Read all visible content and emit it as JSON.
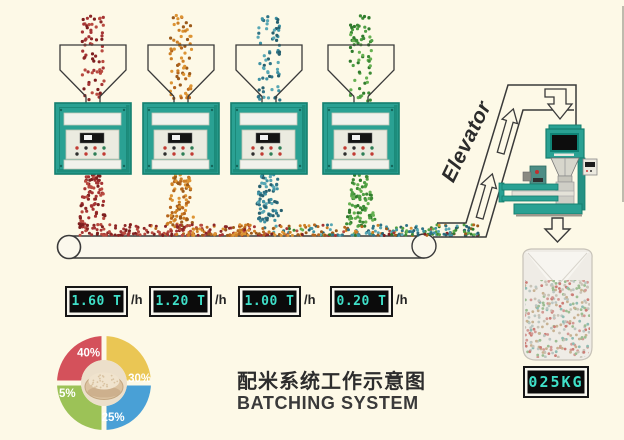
{
  "title": {
    "zh": "配米系统工作示意图",
    "en": "BATCHING SYSTEM"
  },
  "elevator_label": "Elevator",
  "machines": [
    {
      "id": "batcher-1",
      "throughput": "1.60 T",
      "unit": "/h",
      "grain": "red",
      "share": "40%"
    },
    {
      "id": "batcher-2",
      "throughput": "1.20 T",
      "unit": "/h",
      "grain": "orange",
      "share": "30%"
    },
    {
      "id": "batcher-3",
      "throughput": "1.00 T",
      "unit": "/h",
      "grain": "blue",
      "share": "25%"
    },
    {
      "id": "batcher-4",
      "throughput": "0.20 T",
      "unit": "/h",
      "grain": "green",
      "share": "5%"
    }
  ],
  "bag": {
    "weight_display": "025KG"
  },
  "colors": {
    "background": "#fdf9e7",
    "machine_teal": "#2aa193",
    "machine_teal_dark": "#157f6f",
    "lcd_text": "#3fe0c9",
    "outline": "#3a3a3a",
    "panel_light": "#ebebe0",
    "strip_white": "#f1f2ec"
  },
  "grain_palettes": {
    "red": [
      "#a63434",
      "#8c2626",
      "#b94b40",
      "#7d1f1f"
    ],
    "orange": [
      "#cd7f24",
      "#b5651d",
      "#dd9434",
      "#9c5a1a"
    ],
    "blue": [
      "#3f93a5",
      "#2f7386",
      "#58a7b4",
      "#27606f"
    ],
    "green": [
      "#4f9f44",
      "#3c8a35",
      "#66b152",
      "#2f7a2c"
    ],
    "bag_mix": [
      "#d39a94",
      "#8fbcb2",
      "#c8b292",
      "#cc7d76",
      "#9dbd92",
      "#bcc6c1",
      "#c9c3b6"
    ]
  },
  "chart_data": {
    "type": "pie",
    "title": "",
    "labels": [
      "40%",
      "30%",
      "25%",
      "5%"
    ],
    "values": [
      40,
      30,
      25,
      5
    ],
    "colors": [
      "#d4515b",
      "#eac654",
      "#49a0d6",
      "#9cc257"
    ],
    "legend": "none",
    "center_image": "bowl-of-rice",
    "note": "donut rendered as four equal quadrants separated by a background-color cross, percentage labels printed on the segments"
  }
}
